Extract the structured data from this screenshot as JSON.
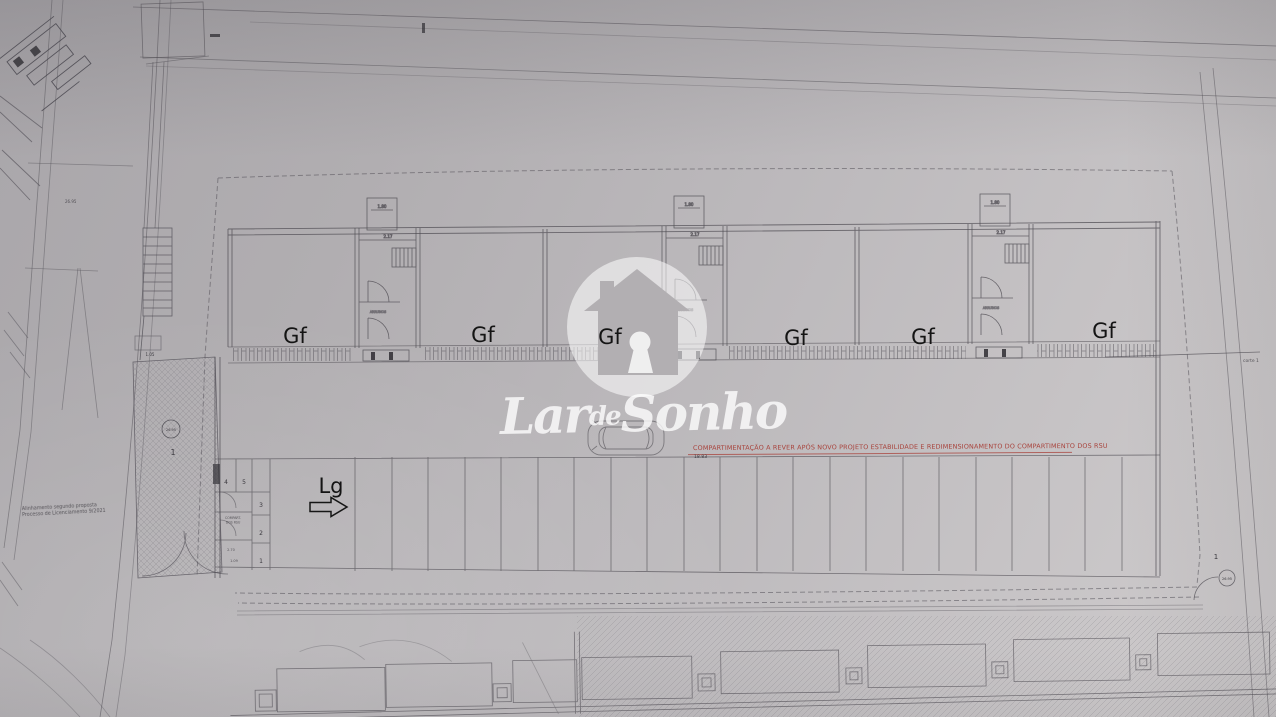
{
  "colors": {
    "paper_top": "#a9a6aa",
    "paper_bottom": "#cfcccd",
    "ink": "#4e4b52",
    "red_note": "#a8423b",
    "annotation": "#141414",
    "watermark": "#ffffff"
  },
  "watermark": {
    "icon": "house-keyhole",
    "word1": "Lar",
    "word2": "de",
    "word3": "Sonho"
  },
  "labels": {
    "gf": [
      "Gf",
      "Gf",
      "Gf",
      "Gf",
      "Gf",
      "Gf"
    ],
    "lg": "Lg"
  },
  "red_note": {
    "text": "COMPARTIMENTAÇÃO A REVER APÓS NOVO PROJETO ESTABILIDADE E REDIMENSIONAMENTO DO COMPARTIMENTO DOS RSU"
  },
  "plan": {
    "section_label": "corte 1",
    "dim_label": "18.83",
    "core_dim": "2.17",
    "core_top_dim": "1.80",
    "core_room_label": "ARRUMOS",
    "hatch_dim": "1.05",
    "room_dims": [
      "2.70",
      "1.09"
    ],
    "elevation": "26.95",
    "lot_label": "1",
    "parking_numbers": [
      "4",
      "5",
      "3",
      "2",
      "1"
    ],
    "rsu_label_line1": "COMPART.",
    "rsu_label_line2": "DOS RSU",
    "left_note_line1": "Alinhamento segundo proposta",
    "left_note_line2": "Processo de Licenciamento 9/2021"
  }
}
